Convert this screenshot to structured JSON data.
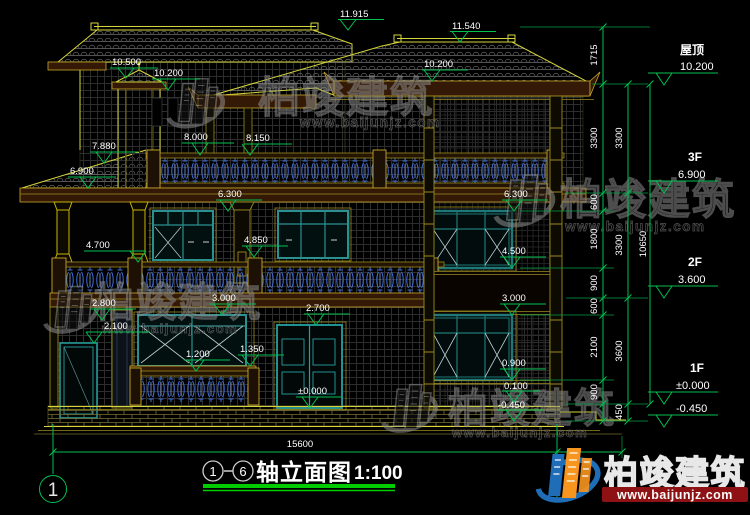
{
  "drawing": {
    "title_axis_start": "1",
    "title_axis_end": "6",
    "title_name": "轴立面图",
    "title_scale": "1:100",
    "axis_bubble_left": "1"
  },
  "levels": {
    "roof": {
      "label": "屋顶",
      "value": "10.200"
    },
    "f3": {
      "label": "3F",
      "value": "6.900"
    },
    "f2": {
      "label": "2F",
      "value": "3.600"
    },
    "f1": {
      "label": "1F",
      "value": "±0.000"
    },
    "base": {
      "label": "",
      "value": "-0.450"
    }
  },
  "spots": {
    "e11915": "11.915",
    "e11540": "11.540",
    "e10500": "10.500",
    "e10200a": "10.200",
    "e10200b": "10.200",
    "e8150": "8.150",
    "e8000": "8.000",
    "e7880": "7.880",
    "e6900": "6.900",
    "e6300a": "6.300",
    "e6300b": "6.300",
    "e4850": "4.850",
    "e4700": "4.700",
    "e4500": "4.500",
    "e3000a": "3.000",
    "e3000b": "3.000",
    "e2800": "2.800",
    "e2700": "2.700",
    "e2100": "2.100",
    "e1350": "1.350",
    "e1200": "1.200",
    "e0900": "0.900",
    "e0000": "±0.000",
    "e0100": "0.100",
    "em450": "-0.450"
  },
  "dims": {
    "c1": [
      "1715",
      "3300",
      "600",
      "1800",
      "900",
      "600",
      "2100",
      "900"
    ],
    "c2": [
      "3300",
      "3300",
      "3600",
      "450"
    ],
    "total": "10650",
    "width": "15600"
  },
  "watermark": {
    "brand": "柏竣建筑",
    "site": "www.baijunjz.com"
  },
  "logo": {
    "brand": "柏竣建筑",
    "site": "www.baijunjz.com"
  },
  "colors": {
    "dim_green": "#00c050",
    "outline_yellow": "#d6d63a",
    "window_teal": "#2b9090",
    "baluster_blue": "#3f6fd8",
    "logo_orange": "#f8951e",
    "logo_blue": "#1e6db6"
  }
}
